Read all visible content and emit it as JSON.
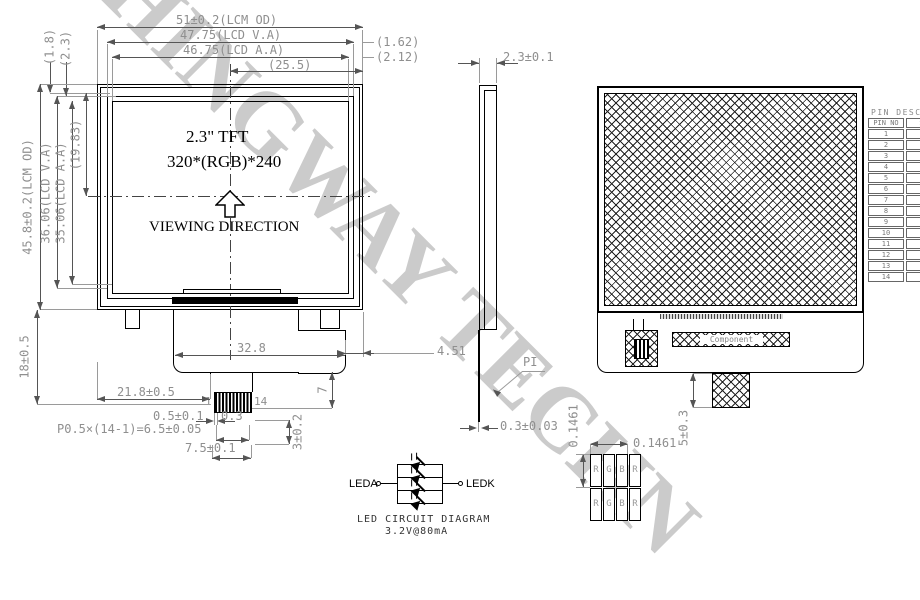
{
  "watermark_text": "CHINGWAY TECHN",
  "front_view": {
    "display_type": "2.3\" TFT",
    "resolution": "320*(RGB)*240",
    "viewing_direction_label": "VIEWING DIRECTION",
    "dim_lcm_width": "51±0.2(LCM OD)",
    "dim_lcd_va_width": "47.75(LCD V.A)",
    "dim_lcd_aa_width": "46.75(LCD A.A)",
    "dim_half_width": "(25.5)",
    "dim_va_margin_right": "(1.62)",
    "dim_aa_margin_right": "(2.12)",
    "dim_top_margin_1": "(1.8)",
    "dim_top_margin_2": "(2.3)",
    "dim_lcm_height": "45.8±0.2(LCM OD)",
    "dim_lcd_va_height": "36.06(LCD V.A)",
    "dim_lcd_aa_height": "35.06(LCD A.A)",
    "dim_center_height": "(19.83)",
    "dim_fpc_drop": "18±0.5",
    "dim_fpc_width": "32.8",
    "dim_pin_offset": "21.8±0.5",
    "dim_edge_step": "4.51",
    "dim_neck_height": "7",
    "pin_first": "1",
    "pin_last": "14",
    "dim_pin_width": "0.5±0.1",
    "dim_pin_gap": "0.3",
    "dim_pin_pitch": "P0.5×(14-1)=6.5±0.05",
    "dim_connector_width": "7.5±0.1",
    "dim_connector_depth": "3±0.2"
  },
  "side_view": {
    "dim_thickness": "2.3±0.1",
    "fpc_label": "PI",
    "dim_fpc_thickness": "0.3±0.03"
  },
  "back_view": {
    "component_label": "Component",
    "dim_tail": "5±0.3",
    "dim_pixel_pitch_h": "0.1461",
    "dim_pixel_pitch_v": "0.1461",
    "subpixels": [
      "R",
      "G",
      "B",
      "R"
    ]
  },
  "pin_table": {
    "title": "PIN DESCRIPTION",
    "headers": [
      "PIN NO",
      "SYMBOL"
    ],
    "rows": [
      {
        "no": "1",
        "symbol": "NC"
      },
      {
        "no": "2",
        "symbol": "NC"
      },
      {
        "no": "3",
        "symbol": "NC"
      },
      {
        "no": "4",
        "symbol": "NC"
      },
      {
        "no": "5",
        "symbol": "NC"
      },
      {
        "no": "6",
        "symbol": "VSS"
      },
      {
        "no": "7",
        "symbol": "VDD"
      },
      {
        "no": "8",
        "symbol": "SDA"
      },
      {
        "no": "9",
        "symbol": "SCL"
      },
      {
        "no": "10",
        "symbol": "CS"
      },
      {
        "no": "11",
        "symbol": "VST"
      },
      {
        "no": "12",
        "symbol": "VCC"
      },
      {
        "no": "13",
        "symbol": "A"
      },
      {
        "no": "14",
        "symbol": "K"
      }
    ]
  },
  "led_circuit": {
    "anode_label": "LEDA",
    "cathode_label": "LEDK",
    "caption": "LED CIRCUIT DIAGRAM",
    "rating": "3.2V@80mA"
  }
}
